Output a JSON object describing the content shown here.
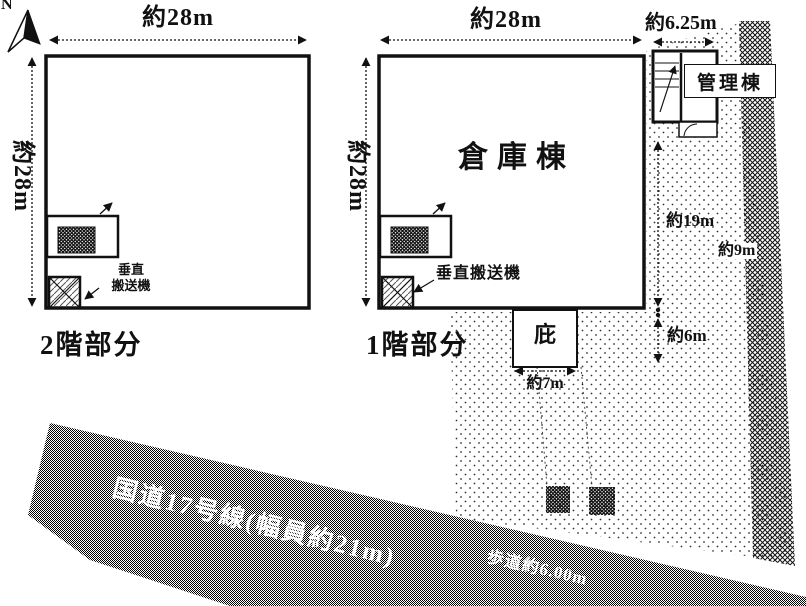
{
  "compass": {
    "label": "N"
  },
  "floor2": {
    "section_label": "2階部分",
    "dim_width": "約28m",
    "dim_height": "約28m",
    "conveyor_label_line1": "垂直",
    "conveyor_label_line2": "搬送機"
  },
  "floor1": {
    "section_label": "1階部分",
    "building_label": "倉庫棟",
    "dim_width": "約28m",
    "dim_height": "約28m",
    "conveyor_label": "垂直搬送機",
    "canopy_label": "庇",
    "canopy_dim": "約7m"
  },
  "management": {
    "building_label": "管理棟",
    "dim_width": "約6.25m",
    "dim_east_upper": "約19m",
    "dim_east_lower": "約6m"
  },
  "roads": {
    "east_road_width": "約9m",
    "main_road_label": "国道17号線(幅員約21m)",
    "sidewalk_label": "歩道約6.00m"
  }
}
